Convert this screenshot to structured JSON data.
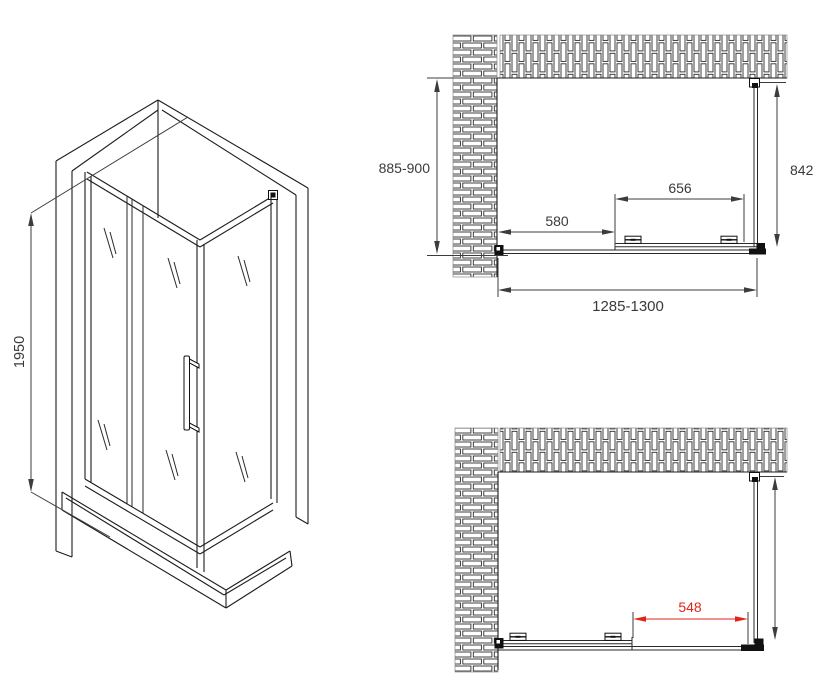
{
  "colors": {
    "line": "#1d1d1b",
    "red": "#e2231a",
    "background": "#ffffff"
  },
  "isometric_view": {
    "height_label": "1950"
  },
  "plan_view_closed": {
    "depth_label": "885-900",
    "side_glass_label": "842",
    "door_width_label": "656",
    "fixed_panel_label": "580",
    "overall_width_label": "1285-1300"
  },
  "plan_view_open": {
    "opening_width_label": "548"
  }
}
